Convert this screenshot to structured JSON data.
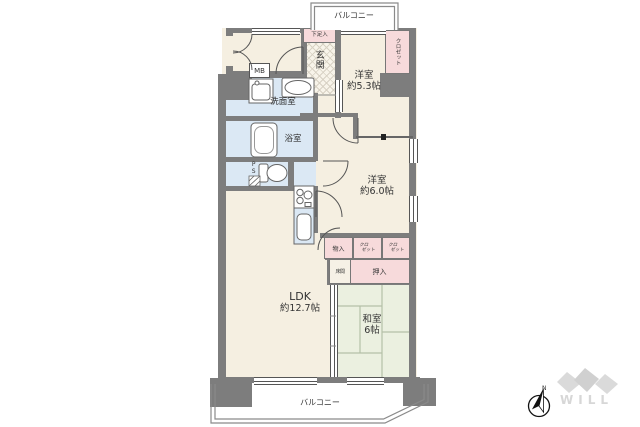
{
  "plan": {
    "balcony_top_label": "バルコニー",
    "balcony_bottom_label": "バルコニー",
    "entrance_label": "玄関",
    "shoe_cabinet_label": "下足入",
    "meter_box_label": "MB",
    "pipe_space_label": "PS",
    "washroom_label": "洗面室",
    "bathroom_label": "浴室",
    "western_room_1": {
      "name": "洋室",
      "size": "約5.3帖"
    },
    "western_room_2": {
      "name": "洋室",
      "size": "約6.0帖"
    },
    "ldk": {
      "name": "LDK",
      "size": "約12.7帖"
    },
    "japanese_room": {
      "name": "和室",
      "size": "6帖"
    },
    "closet_upper_label": "クロゼット",
    "storage_label": "物入",
    "closet_a": {
      "line1": "クロ",
      "line2": "ゼット"
    },
    "closet_b": {
      "line1": "クロ",
      "line2": "ゼット"
    },
    "oshiire_label": "押入",
    "tokonoma_label": "床間"
  },
  "compass": {
    "north_label": "N"
  },
  "logo": {
    "text": "WILL"
  },
  "colors": {
    "wall": "#7d7d7d",
    "room_beige": "#f5efe1",
    "closet_pink": "#f7dadb",
    "wet_blue": "#dbe8f4",
    "tatami_green": "#ebf0e0",
    "logo_gray": "#d7d7d7"
  }
}
